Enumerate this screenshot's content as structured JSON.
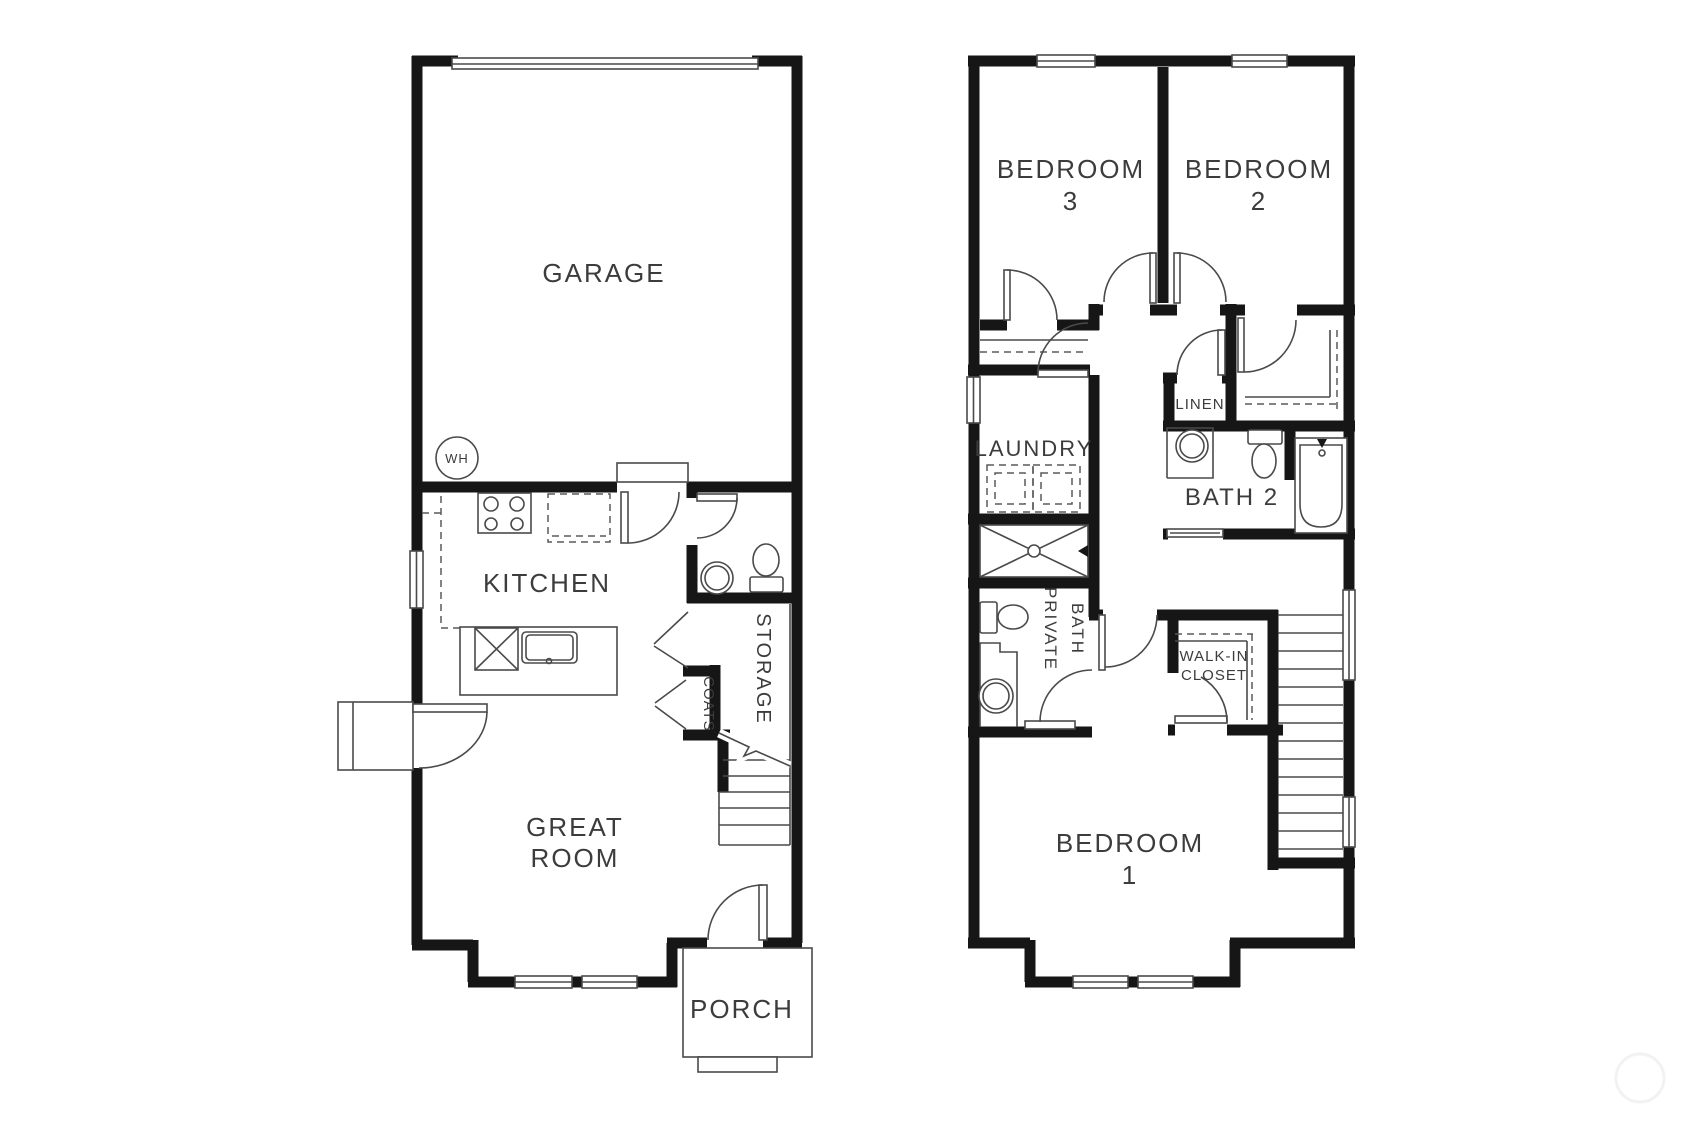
{
  "floorplan": {
    "type": "two-story townhouse floor plan",
    "colors": {
      "wall": "#161616",
      "line": "#4a4a4a",
      "background": "#ffffff",
      "text": "#3c3c3c"
    },
    "first_floor": {
      "rooms": {
        "garage": "GARAGE",
        "water_heater": "WH",
        "kitchen": "KITCHEN",
        "storage": "STORAGE",
        "coats": "COATS",
        "great_room_line1": "GREAT",
        "great_room_line2": "ROOM",
        "porch": "PORCH"
      }
    },
    "second_floor": {
      "rooms": {
        "bedroom3_line1": "BEDROOM",
        "bedroom3_line2": "3",
        "bedroom2_line1": "BEDROOM",
        "bedroom2_line2": "2",
        "laundry": "LAUNDRY",
        "linen": "LINEN",
        "bath2": "BATH 2",
        "private_bath_line1": "PRIVATE",
        "private_bath_line2": "BATH",
        "walk_in_closet_line1": "WALK-IN",
        "walk_in_closet_line2": "CLOSET",
        "bedroom1_line1": "BEDROOM",
        "bedroom1_line2": "1"
      }
    }
  }
}
